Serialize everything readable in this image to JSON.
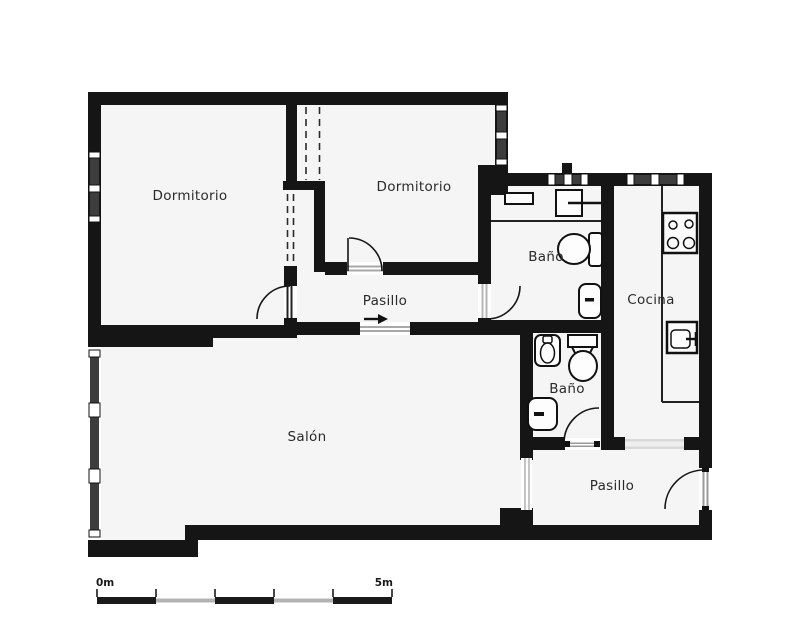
{
  "page": {
    "background": "#ffffff"
  },
  "floorplan": {
    "rooms": {
      "dormitorio_1": {
        "label": "Dormitorio"
      },
      "dormitorio_2": {
        "label": "Dormitorio"
      },
      "bano_1": {
        "label": "Baño"
      },
      "cocina": {
        "label": "Cocina"
      },
      "pasillo_1": {
        "label": "Pasillo"
      },
      "salon": {
        "label": "Salón"
      },
      "bano_2": {
        "label": "Baño"
      },
      "pasillo_2": {
        "label": "Pasillo"
      }
    },
    "fixtures": {
      "bano_1": [
        "shelf",
        "counter-sink",
        "toilet",
        "washbasin"
      ],
      "bano_2": [
        "bidet",
        "toilet",
        "washbasin"
      ],
      "cocina": [
        "stove-4-burner",
        "kitchen-sink",
        "counter"
      ]
    },
    "symbols": [
      "door-swing-arc",
      "window",
      "wardrobe-dashed-lines",
      "direction-arrow"
    ],
    "scale_bar": {
      "start_label": "0m",
      "end_label": "5m"
    },
    "colors": {
      "wall": "#151515",
      "floor": "#f5f5f5",
      "window_glass": "#3d3d3d",
      "threshold": "#d8d8d8",
      "scale_dark": "#1a1a1a",
      "scale_light": "#b3b3b3",
      "label": "#2a2a2a"
    }
  }
}
